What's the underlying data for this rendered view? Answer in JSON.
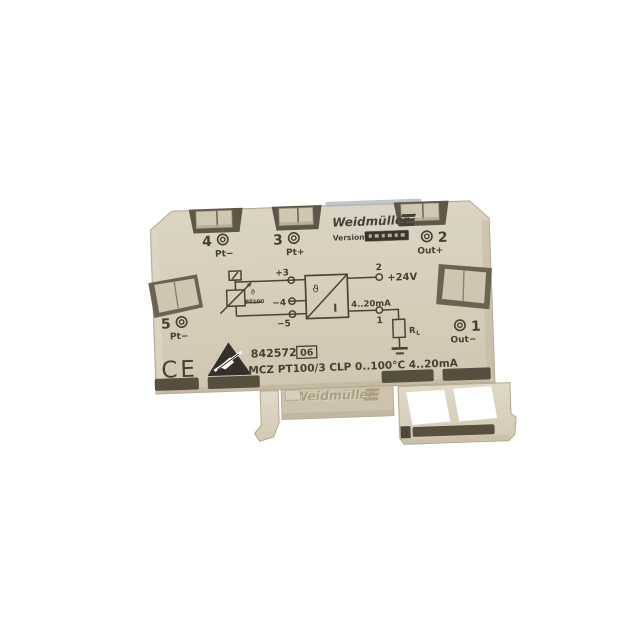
{
  "brand": {
    "name": "Weidmüller"
  },
  "labels": {
    "version": "Version",
    "order_number": "842572",
    "revision": "06",
    "type_designation": "MCZ PT100/3 CLP 0..100°C 4..20mA",
    "ce": "CE"
  },
  "terminals": {
    "t4": {
      "num": "4",
      "label": "Pt−"
    },
    "t3": {
      "num": "3",
      "label": "Pt+"
    },
    "t2": {
      "num": "2",
      "label": "Out+"
    },
    "t5": {
      "num": "5",
      "label": "Pt−"
    },
    "t1": {
      "num": "1",
      "label": "Out−"
    }
  },
  "schematic": {
    "sensor": "PT100",
    "theta": "ϑ",
    "current": "I",
    "pin_plus": "+3",
    "pin_minus4": "−4",
    "pin_minus5": "−5",
    "pin_out2": "2",
    "supply": "+24V",
    "signal_range": "4..20mA",
    "pin_out1": "1",
    "load_resistor": "R",
    "load_sub": "L"
  },
  "embossed": {
    "brand": "Weidmüller"
  },
  "colors": {
    "body": "#d6cdb9",
    "body_dark": "#c8bda6",
    "slot_dark": "#5a5243",
    "print": "#464034",
    "foot": "#dcd4c1",
    "emboss": "#b2a68a",
    "badge": "#3a352c"
  }
}
